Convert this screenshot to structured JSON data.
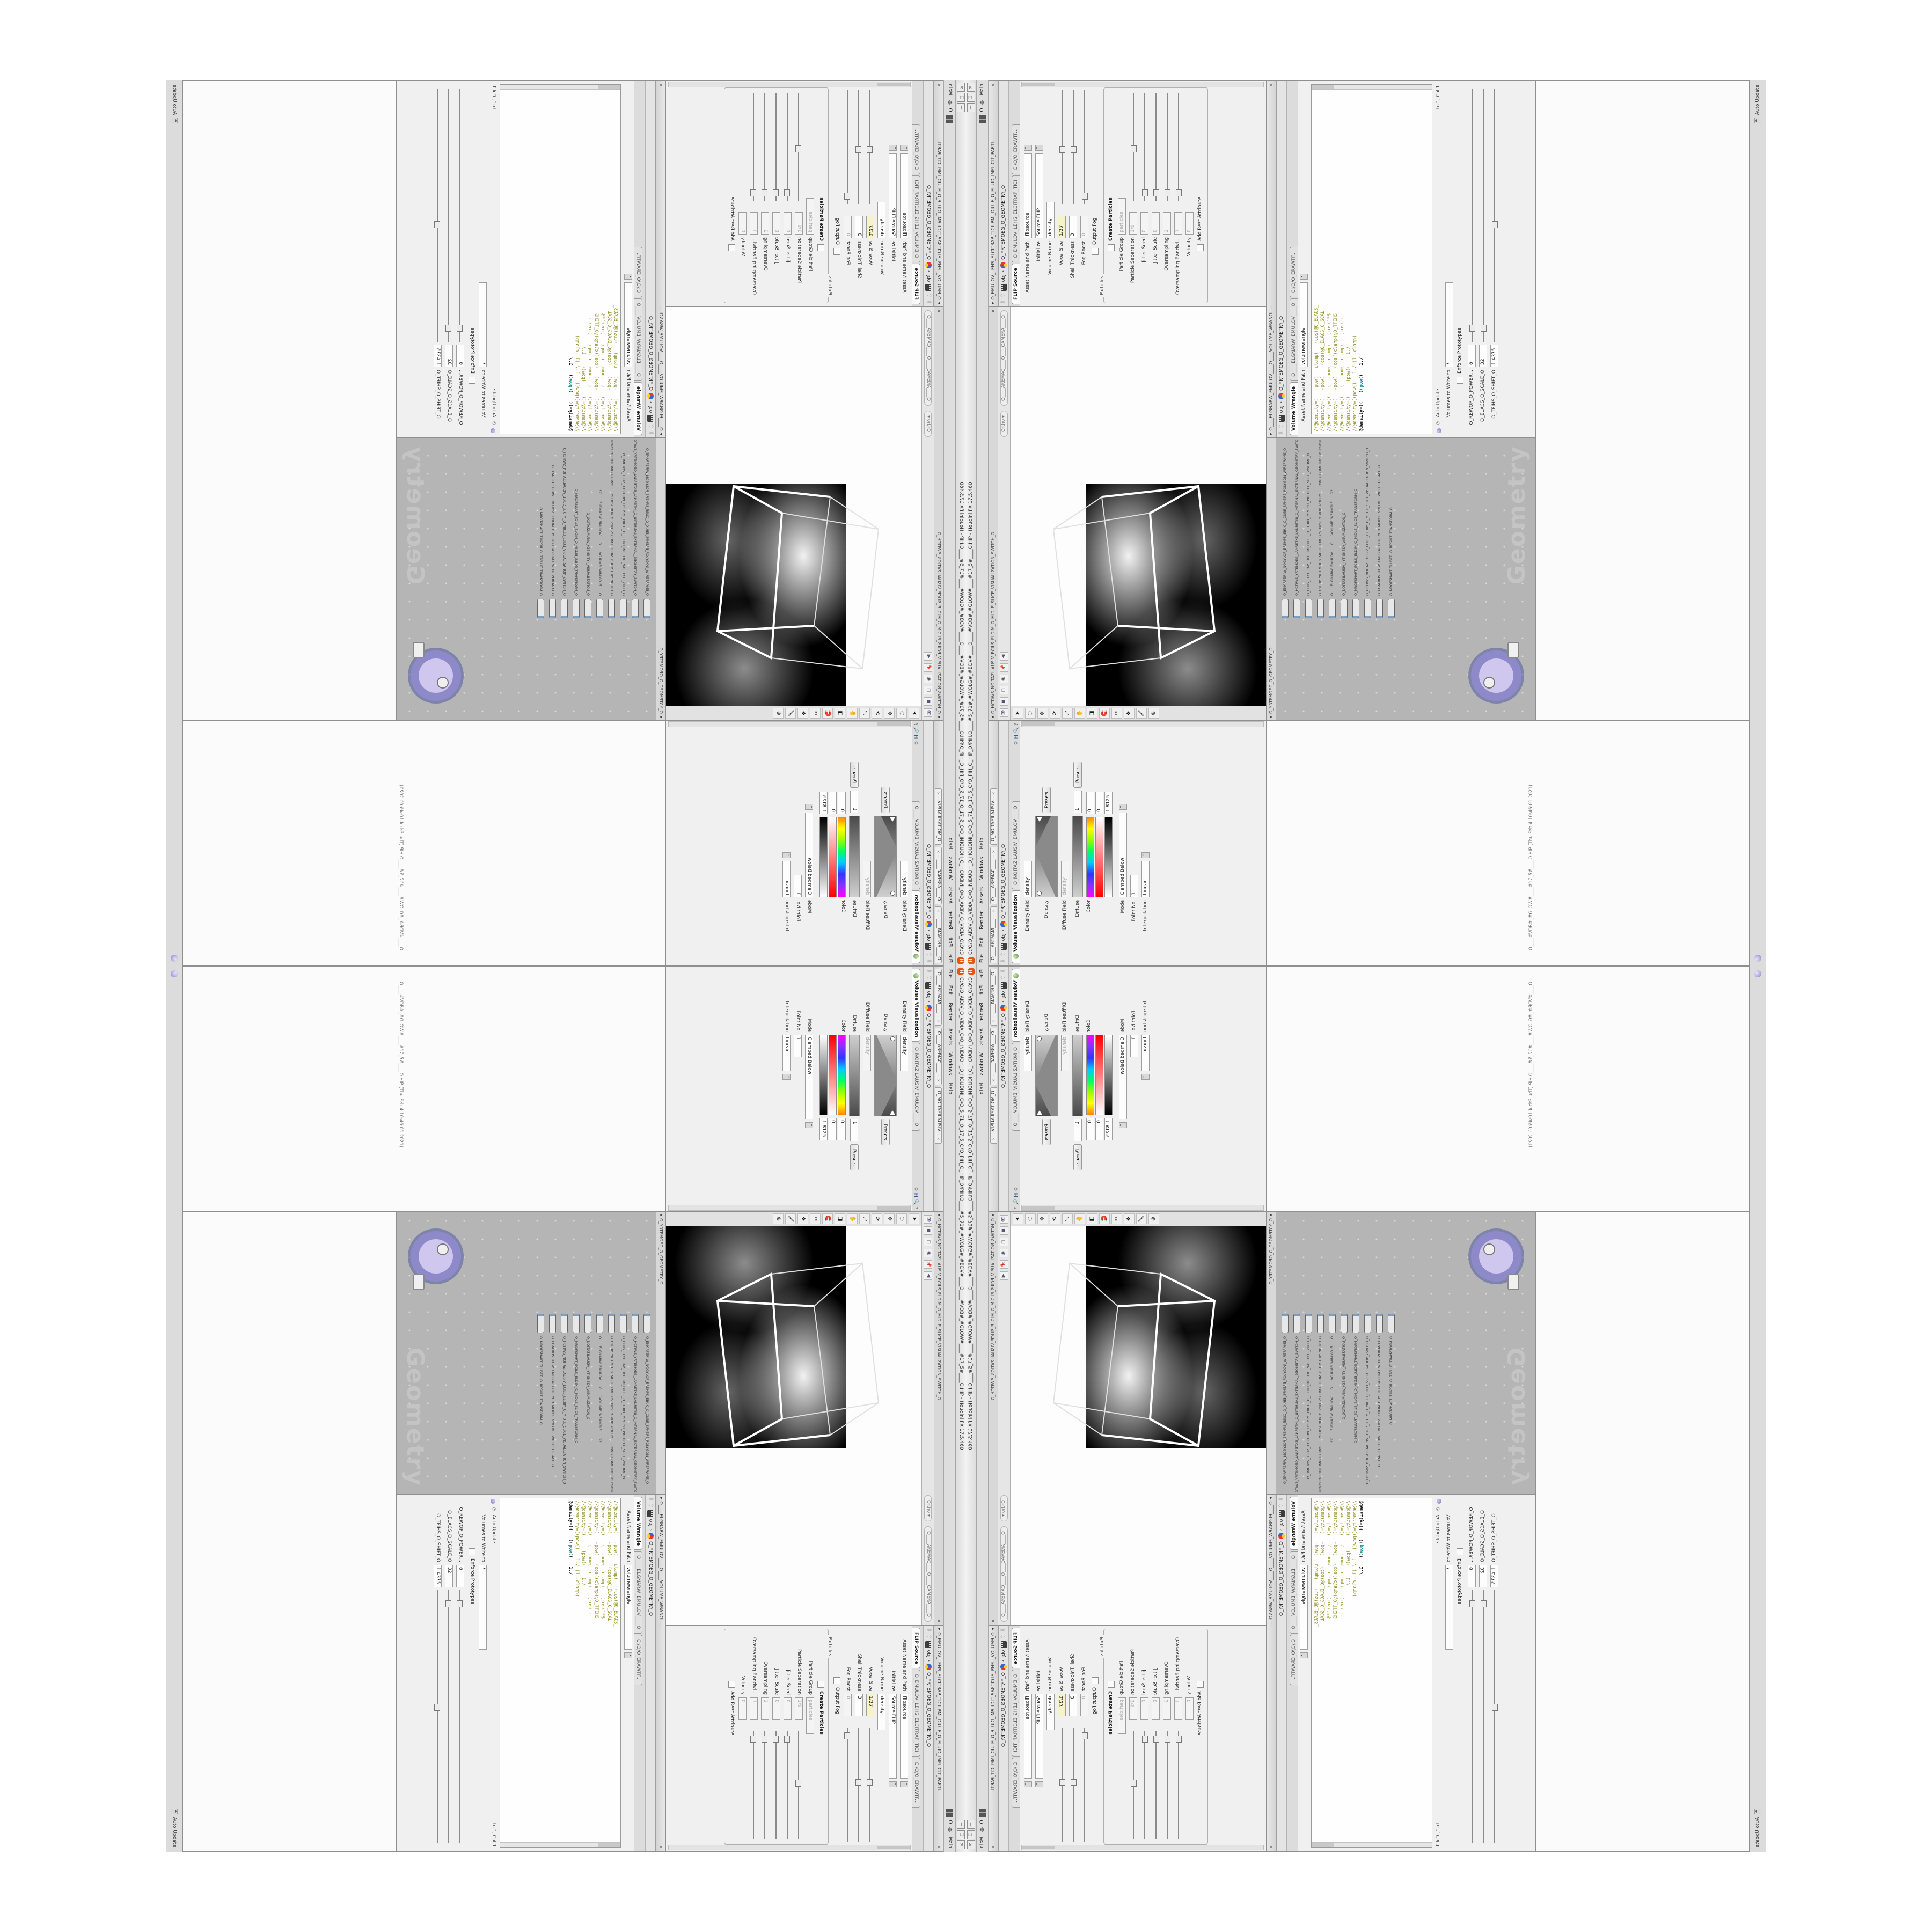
{
  "colors": {
    "accent_yellow": "#f6f4c4",
    "code_olive": "#8f8f1f",
    "code_teal": "#0e8f8f",
    "network_grey": "#b5b5b5",
    "node_purple": "#7d6fc0",
    "logo_orange": "#e8550f"
  },
  "window": {
    "title": "C:/O/O_AIDIV_O_VIDIA_O/O_INIDUOH_O_HOUDINI_O/O_5_71_O_17_5_O/O_PIH_O_HIP_O/PIH.O____#5_71#_#WOLG#_#BDV#____O____#VDB#_#GLOW#____#17_5#____O.HIP - Houdini FX 17.5.460",
    "logo": "H",
    "minimize": "—",
    "maximize": "❐",
    "close": "✕"
  },
  "menubar": {
    "items": [
      {
        "label": "File"
      },
      {
        "label": "Edit"
      },
      {
        "label": "Render"
      },
      {
        "label": "Assets"
      },
      {
        "label": "Windows"
      },
      {
        "label": "Help"
      }
    ],
    "layout_label": "O",
    "desktop_label": "Main",
    "desktop_icon": "✥"
  },
  "volvis": {
    "tabs": [
      {
        "label": "O____ARTNAM____..."
      },
      {
        "label": "O____AREMAC____..."
      },
      {
        "label": "O_NOITAZILAUSIV..."
      }
    ],
    "path_root": "obj",
    "path_node": "O_YRTEMOEG_O_GEOMETRY_O",
    "nav_up": "⇧",
    "nav_down": "⇩",
    "tab_active": "Volume Visualization",
    "tab_operator": "O_NOITAZILAUSIV_EMULOV____O",
    "help_icon": "?",
    "gear_icon": "⚙",
    "hlogo_icon": "H",
    "search_icon": "🔍",
    "rows": {
      "density_field_label": "Density Field",
      "density_field_value": "density",
      "density_ramp_label": "Density",
      "density_presets": "Presets",
      "diffuse_field_label": "Diffuse Field",
      "diffuse_field_value": "density",
      "diffuse_ramp_label": "Diffuse",
      "diffuse_point": "1",
      "diffuse_presets": "Presets",
      "color_label": "Color",
      "hue_value": "0",
      "sat_value": "0",
      "val_value": "1.8125",
      "mode_label": "Mode",
      "mode_value": "Clamped Below",
      "point_label": "Point No.",
      "point_value": "1",
      "interp_label": "Interpolation",
      "interp_value": "Linear"
    }
  },
  "viewport": {
    "header": "O_HCTIWS_NOITAZILAUSIV_ECILS_ELDIM_O_MIDLE_SLICE_VISUALIZATION_SWITCH_O",
    "close_icon": "✕",
    "top_icons": [
      {
        "g": "👁"
      },
      {
        "g": "◼"
      },
      {
        "g": "◻"
      },
      {
        "g": "◉"
      },
      {
        "g": "📌"
      },
      {
        "g": "◀"
      }
    ],
    "ortho_pill": "Ortho ▾",
    "camera_pill": "O____AREMAC____O____CAMERA____O",
    "tool_icons": [
      {
        "g": "➤"
      },
      {
        "g": "◌"
      },
      {
        "g": "✥"
      },
      {
        "g": "⟳"
      },
      {
        "g": "⤢"
      },
      {
        "g": "✋"
      },
      {
        "g": "◨"
      },
      {
        "g": "🧲"
      },
      {
        "g": "✂"
      },
      {
        "g": "❖"
      },
      {
        "g": "🖌"
      },
      {
        "g": "⊕"
      }
    ]
  },
  "flip": {
    "header": "O_EMULOV_LEHS_ELCITRAP_TICILPMI_DIULF_O_FLUID_IMPLICIT_PARTI...",
    "close_icon": "✕",
    "path_root": "obj",
    "path_node": "O_YRTEMOEG_O_GEOMETRY_O",
    "tab_active": "FLIP Source",
    "tab_operator": "O_EMULOV_LEHS_ELCITRAP_TICI",
    "tab_file": "C:/O/O_ERAWTF...",
    "rows": [
      {
        "label": "Asset Name and Path",
        "value": "flipsource",
        "vcls": "pfield wide",
        "scls": "sl hide",
        "dcls": "dd"
      },
      {
        "label": "Initialize",
        "value": "Source FLIP",
        "vcls": "pfield wide",
        "scls": "sl hide",
        "dcls": "dd"
      },
      {
        "label": "Volume Name",
        "value": "density",
        "vcls": "pfield",
        "scls": "sl hide",
        "dcls": "dd hide"
      },
      {
        "label": "Voxel Size",
        "value": "1/27",
        "vcls": "pfield yellow num",
        "scls": "sl",
        "dcls": "dd hide"
      },
      {
        "label": "Shell Thickness",
        "value": "3",
        "vcls": "pfield num",
        "scls": "sl",
        "dcls": "dd hide"
      },
      {
        "label": "Fog Boost",
        "value": "0",
        "vcls": "pfield grey num",
        "scls": "sl left",
        "dcls": "dd hide"
      }
    ],
    "output_fog_label": "Output Fog",
    "particles_group": {
      "title": "Particles",
      "create_label": "Create Particles",
      "rows": [
        {
          "label": "Particle Group",
          "value": "particles",
          "vcls": "pfield grey",
          "scls": "sl hide",
          "dcls": "dd hide"
        },
        {
          "label": "Particle Separation",
          "value": "1/9",
          "vcls": "pfield grey num",
          "scls": "sl",
          "dcls": "dd hide"
        },
        {
          "label": "Jitter Seed",
          "value": "0",
          "vcls": "pfield grey num",
          "scls": "sl left",
          "dcls": "dd hide"
        },
        {
          "label": "Jitter Scale",
          "value": "0",
          "vcls": "pfield grey num",
          "scls": "sl left",
          "dcls": "dd hide"
        },
        {
          "label": "Oversampling",
          "value": "2",
          "vcls": "pfield grey num",
          "scls": "sl left",
          "dcls": "dd hide"
        },
        {
          "label": "Oversampling Bandwi...",
          "value": "1",
          "vcls": "pfield grey num",
          "scls": "sl left",
          "dcls": "dd hide"
        },
        {
          "label": "Velocity",
          "value": "0",
          "vcls": "pfield grey num",
          "scls": "sl hide",
          "dcls": "dd hide"
        }
      ],
      "rest_label": "Add Rest Attribute"
    }
  },
  "network": {
    "header": "O_YRTEMOEG_O_GEOMETRY_O",
    "watermark": "Geometry",
    "nodes": [
      {
        "name": "O_EMARFERIW_NOGYLOP_EREHPS_EBUC_O_CUBE_SPHERE_POLYGON_WIREFRAME_O"
      },
      {
        "name": "O_HCTIWS_YRTEMOEG_LANRETXE_LANRETNI_O_INTERNAL_EXTERNAL_GEOMETRY_SWITCH_O"
      },
      {
        "name": "O_LEHS_ELCITRAP_TICILPMI_DIULF_O_FLUID_IMPLICIT_PARTICLE_SHEL_VOLUME_O"
      },
      {
        "name": "O_GYLOP_YRTEMOEG_MORF_EMULOV_BDV_O_VDB_VOLUME_FROM_GEOMETRY_POLYGON_O"
      },
      {
        "name": "O____ELGNARW_EMULOV____O____VOLUME_WRANGLE____O2"
      },
      {
        "name": "O_NOITAZILAUSIV_(YTISNED)_VISUALIZATION_O"
      },
      {
        "name": "O_MROFSNART_ECILS_ELDIM_O_MIDLE_SLICE_TRANSFORM_O"
      },
      {
        "name": "O_HCTIWS_NOITAZILAUSIV_ECILS_ELDIM_O_MIDLE_SLICE_VISUALIZATION_SWITCH_O"
      },
      {
        "name": "O_ECAFRUS_HTIW_EMULOV_EGREM_O_MERGE_VOLUME_WITH_SURFACE_O"
      },
      {
        "name": "O_MROFSNART_TLUSER_O_RESULT_TRANSFORM_O"
      }
    ]
  },
  "wrangle": {
    "header": "O____ELGNARW_EMULOV____O____VOLUME_WRANGL...",
    "close_icon": "✕",
    "path_root": "obj",
    "path_node": "O_YRTEMOEG_O_GEOMETRY_O",
    "tab_active": "Volume Wrangle",
    "tab_operator": "O____ELGNARW_EMULOV____O",
    "tab_file": "C:/O/O_ERAWTF...",
    "asset_label": "Asset Name and Path",
    "asset_value": "volumewrangle",
    "code_lines": [
      {
        "t": "//@density=(   -pow(   clamp(   (cos(@O_ELACS_"
      },
      {
        "t": "//@density=(   -pow(    (cos(@O_ELACS_O_SCAL"
      },
      {
        "t": "//@density=((   (  -pow(  clamp(   (cos(1*$"
      },
      {
        "t": "//@density=(   -pow(   (cos((clamp(@O_TFIHS"
      },
      {
        "t": "//@density=((   (  -pow(  clamp(   (cos( c"
      },
      {
        "t": "//@density=((     (pow((    1./"
      },
      {
        "t": "//@density=((pow((   1./ (1.-clamp("
      }
    ],
    "active_pre": "@density=((   ((",
    "active_kw": "pow",
    "active_post": "((   1./",
    "auto_update": "Auto Update",
    "refresh_icon": "⟳",
    "lncol": "Ln 1, Col 1",
    "volumes_label": "Volumes to Write to",
    "volumes_value": "*",
    "enforce_label": "Enforce Prototypes",
    "sliders": [
      {
        "label": "O_REWOP_O_POWER...",
        "value": "6"
      },
      {
        "label": "O_ELACS_O_SCALE_O",
        "value": "32"
      },
      {
        "label": "O_TFIHS_O_SHIFT_O",
        "value": "1.4375"
      }
    ]
  },
  "status": {
    "saved_message": "O____#VDB#_#GLOW#____#17_5#____O.HIP (Thu Feb 4 10:46:01 2021)",
    "auto_update": "Auto Update"
  }
}
